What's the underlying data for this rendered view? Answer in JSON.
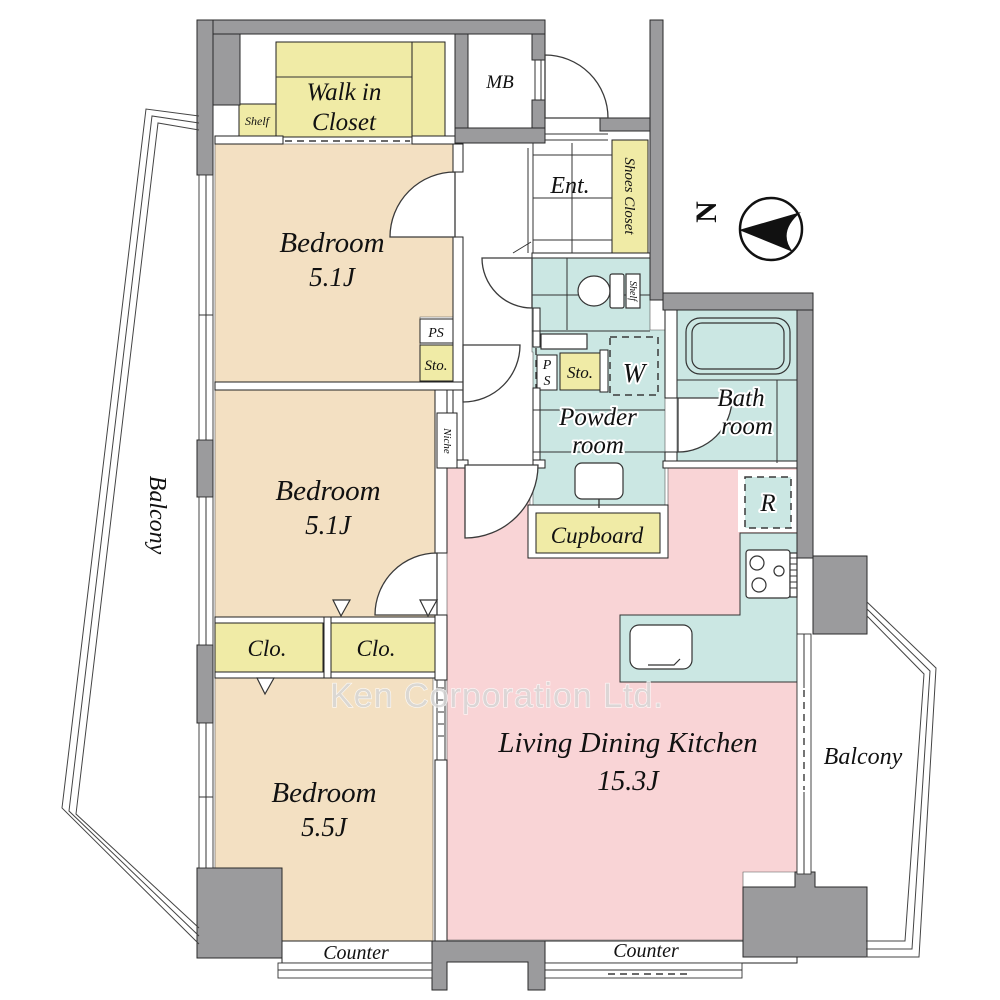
{
  "colors": {
    "wall_gray": "#9b9b9d",
    "bedroom_tan": "#f3e0c2",
    "closet_yellow": "#f0eba6",
    "water_blue": "#cbe7e3",
    "ldk_pink": "#f9d4d6",
    "outline": "#2a2a2a",
    "watermark_gray": "#d7d7d7"
  },
  "rooms": {
    "wic": {
      "line1": "Walk in",
      "line2": "Closet"
    },
    "bedroom1": {
      "name": "Bedroom",
      "size": "5.1J"
    },
    "bedroom2": {
      "name": "Bedroom",
      "size": "5.1J"
    },
    "bedroom3": {
      "name": "Bedroom",
      "size": "5.5J"
    },
    "ldk": {
      "name": "Living Dining Kitchen",
      "size": "15.3J"
    },
    "powder": {
      "line1": "Powder",
      "line2": "room"
    },
    "bath": {
      "line1": "Bath",
      "line2": "room"
    },
    "ent": "Ent.",
    "shoes_closet": "Shoes Closet",
    "cupboard": "Cupboard"
  },
  "small_labels": {
    "shelf_wic": "Shelf",
    "mb": "MB",
    "ps_upper": "PS",
    "sto_upper": "Sto.",
    "niche": "Niche",
    "shelf_toilet": "Shelf",
    "ps_lower_p": "P",
    "ps_lower_s": "S",
    "sto_lower": "Sto.",
    "washer": "W",
    "fridge": "R",
    "clo_left": "Clo.",
    "clo_right": "Clo."
  },
  "balconies": {
    "left": "Balcony",
    "right": "Balcony"
  },
  "counters": {
    "left": "Counter",
    "right": "Counter"
  },
  "compass": {
    "north": "N"
  },
  "watermark": "Ken Corporation Ltd."
}
